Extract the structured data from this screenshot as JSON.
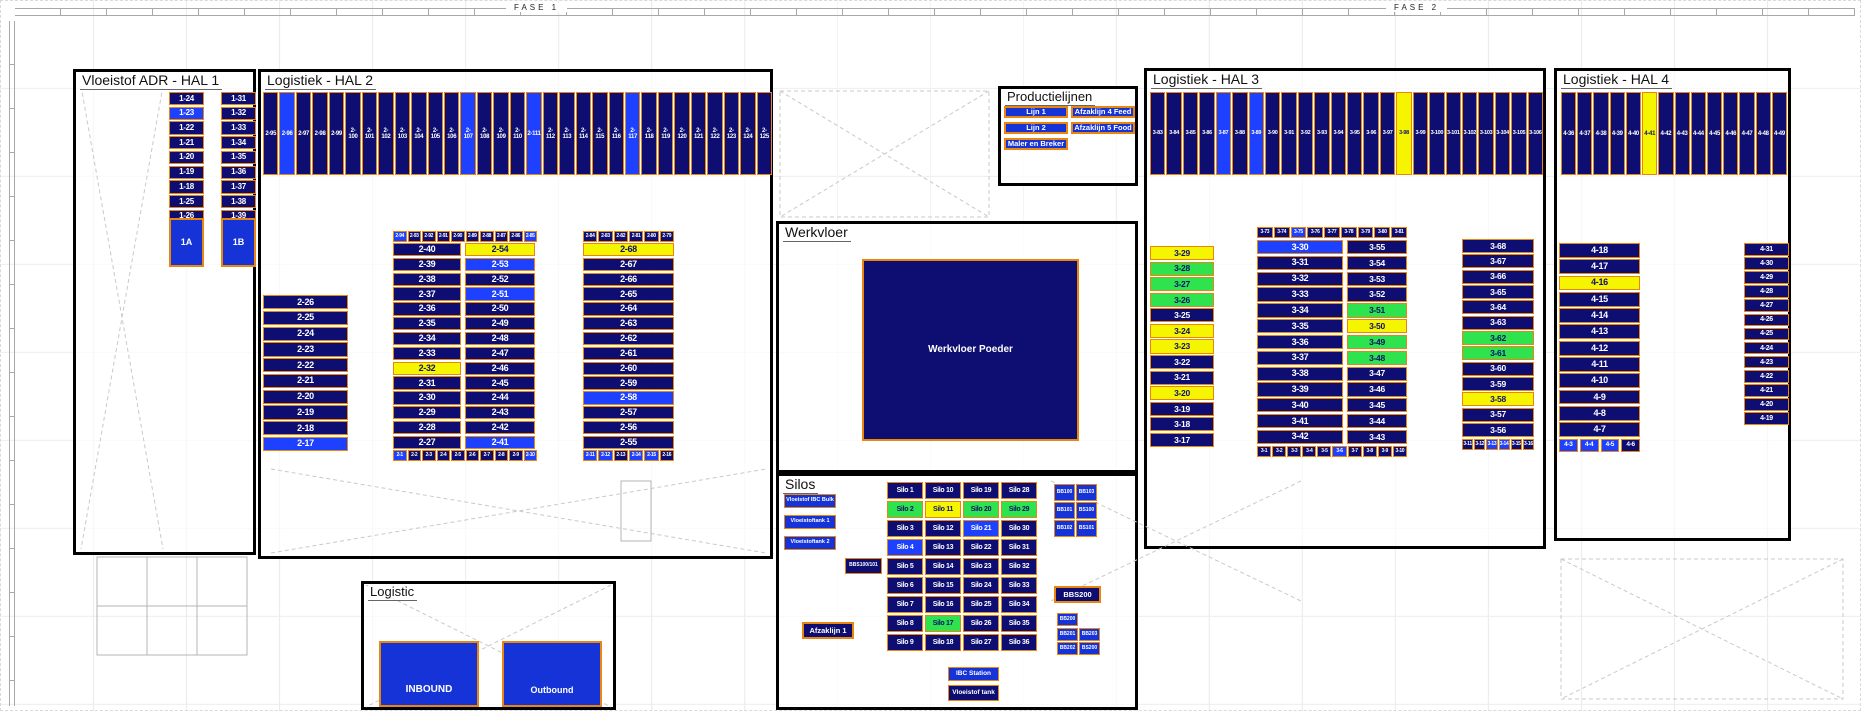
{
  "colors": {
    "navy": "#0e0e72",
    "hblue": "#1e40ff",
    "bblue": "#1533d6",
    "yellow": "#f5f500",
    "green": "#2fe34f",
    "orange": "#e8860d"
  },
  "ruler": {
    "fase1": "FASE 1",
    "fase2": "FASE 2"
  },
  "zones": {
    "hal1": {
      "title": "Vloeistof ADR - HAL 1",
      "col1": [
        "1-24",
        {
          "t": "1-23",
          "s": "b"
        },
        "1-22",
        "1-21",
        "1-20",
        "1-19",
        "1-18",
        "1-25",
        "1-26"
      ],
      "col2": [
        "1-31",
        "1-32",
        "1-33",
        "1-34",
        "1-35",
        "1-36",
        "1-37",
        "1-38",
        "1-39"
      ],
      "big1": "1A",
      "big2": "1B"
    },
    "hal2": {
      "title": "Logistiek - HAL 2",
      "top_row": [
        "2-95",
        {
          "t": "2-96",
          "s": "b"
        },
        "2-97",
        "2-98",
        "2-99",
        "2-100",
        "2-101",
        "2-102",
        "2-103",
        "2-104",
        "2-105",
        "2-106",
        {
          "t": "2-107",
          "s": "b"
        },
        "2-108",
        "2-109",
        "2-110",
        {
          "t": "2-111",
          "s": "b"
        },
        "2-112",
        "2-113",
        "2-114",
        "2-115",
        "2-116",
        {
          "t": "2-117",
          "s": "b"
        },
        "2-118",
        "2-119",
        "2-120",
        "2-121",
        "2-122",
        "2-123",
        "2-124",
        "2-125"
      ],
      "left_col": [
        "2-26",
        "2-25",
        "2-24",
        "2-23",
        "2-22",
        "2-21",
        "2-20",
        "2-19",
        "2-18",
        {
          "t": "2-17",
          "s": "b"
        }
      ],
      "g1_top": [
        {
          "t": "2-94",
          "s": "b"
        },
        "2-93",
        "2-92",
        "2-91",
        "2-90",
        "2-89",
        "2-88",
        "2-87",
        "2-86",
        {
          "t": "2-85",
          "s": "b"
        }
      ],
      "g1_colA": [
        "2-40",
        "2-39",
        "2-38",
        "2-37",
        "2-36",
        "2-35",
        "2-34",
        "2-33",
        {
          "t": "2-32",
          "s": "y"
        },
        "2-31",
        "2-30",
        "2-29",
        "2-28",
        "2-27"
      ],
      "g1_colB": [
        {
          "t": "2-54",
          "s": "y"
        },
        {
          "t": "2-53",
          "s": "b"
        },
        "2-52",
        {
          "t": "2-51",
          "s": "b"
        },
        "2-50",
        "2-49",
        "2-48",
        "2-47",
        "2-46",
        "2-45",
        "2-44",
        "2-43",
        "2-42",
        {
          "t": "2-41",
          "s": "b"
        }
      ],
      "g1_bottom": [
        {
          "t": "2-1",
          "s": "b"
        },
        "2-2",
        "2-3",
        "2-4",
        "2-5",
        "2-6",
        "2-7",
        "2-8",
        "2-9",
        {
          "t": "2-10",
          "s": "b"
        }
      ],
      "g2_top": [
        "2-84",
        "2-83",
        "2-82",
        "2-81",
        "2-80",
        "2-79"
      ],
      "g2_col": [
        {
          "t": "2-68",
          "s": "y"
        },
        "2-67",
        "2-66",
        "2-65",
        "2-64",
        "2-63",
        "2-62",
        "2-61",
        "2-60",
        "2-59",
        {
          "t": "2-58",
          "s": "b"
        },
        "2-57",
        "2-56",
        "2-55"
      ],
      "g2_bottom": [
        {
          "t": "2-11",
          "s": "b"
        },
        {
          "t": "2-12",
          "s": "b"
        },
        "2-13",
        {
          "t": "2-14",
          "s": "b"
        },
        {
          "t": "2-15",
          "s": "b"
        },
        "2-16"
      ]
    },
    "productielijnen": {
      "title": "Productielijnen",
      "left_buttons": [
        "Lijn 1",
        "Lijn 2",
        "Maler en Breker"
      ],
      "right_buttons": [
        "Afzaklijn 4 Feed",
        "Afzaklijn 5 Food"
      ]
    },
    "werkvloer": {
      "title": "Werkvloer",
      "box_label": "Werkvloer Poeder"
    },
    "silos": {
      "title": "Silos",
      "left_tanks": [
        "Vloeistof IBC Bulk",
        "Vloeistoftank 1",
        "Vloeistoftank 2"
      ],
      "bbs100": "BBS100/101",
      "afzaklijn1": "Afzaklijn 1",
      "grid": [
        "Silo 1",
        "Silo 10",
        "Silo 19",
        "Silo 28",
        {
          "t": "Silo 2",
          "s": "g"
        },
        {
          "t": "Silo 11",
          "s": "y"
        },
        {
          "t": "Silo 20",
          "s": "g"
        },
        {
          "t": "Silo 29",
          "s": "g"
        },
        "Silo 3",
        "Silo 12",
        {
          "t": "Silo 21",
          "s": "b"
        },
        "Silo 30",
        {
          "t": "Silo 4",
          "s": "b"
        },
        "Silo 13",
        "Silo 22",
        "Silo 31",
        "Silo 5",
        "Silo 14",
        "Silo 23",
        "Silo 32",
        "Silo 6",
        "Silo 15",
        "Silo 24",
        "Silo 33",
        "Silo 7",
        "Silo 16",
        "Silo 25",
        "Silo 34",
        "Silo 8",
        {
          "t": "Silo 17",
          "s": "g"
        },
        "Silo 26",
        "Silo 35",
        "Silo 9",
        "Silo 18",
        "Silo 27",
        "Silo 36"
      ],
      "right_top": [
        "BB100",
        "BB103",
        "BB101",
        "BS100",
        "BB102",
        "BS101"
      ],
      "bbs200": "BBS200",
      "bb200": "BB200",
      "right_bottom": [
        "BB201",
        "BB203",
        "BB202",
        "BS200"
      ],
      "ibc_station": "IBC Station",
      "vloeistof_tank": "Vloeistof tank"
    },
    "hal3": {
      "title": "Logistiek - HAL 3",
      "top_row": [
        "3-83",
        "3-84",
        "3-85",
        "3-86",
        {
          "t": "3-87",
          "s": "b"
        },
        "3-88",
        {
          "t": "3-89",
          "s": "b"
        },
        "3-90",
        "3-91",
        "3-92",
        "3-93",
        "3-94",
        "3-95",
        "3-96",
        "3-97",
        {
          "t": "3-98",
          "s": "y"
        },
        "3-99",
        "3-100",
        "3-101",
        "3-102",
        "3-103",
        "3-104",
        "3-105",
        "3-106"
      ],
      "colA": [
        {
          "t": "3-29",
          "s": "y"
        },
        {
          "t": "3-28",
          "s": "g"
        },
        {
          "t": "3-27",
          "s": "g"
        },
        {
          "t": "3-26",
          "s": "g"
        },
        "3-25",
        {
          "t": "3-24",
          "s": "y"
        },
        {
          "t": "3-23",
          "s": "y"
        },
        "3-22",
        "3-21",
        {
          "t": "3-20",
          "s": "y"
        },
        "3-19",
        "3-18",
        "3-17"
      ],
      "bc_top": [
        "3-73",
        "3-74",
        {
          "t": "3-75",
          "s": "b"
        },
        "3-76",
        "3-77",
        "3-78",
        "3-79",
        "3-80",
        "3-81"
      ],
      "colB": [
        {
          "t": "3-30",
          "s": "b"
        },
        "3-31",
        "3-32",
        "3-33",
        "3-34",
        "3-35",
        "3-36",
        "3-37",
        "3-38",
        "3-39",
        "3-40",
        "3-41",
        "3-42"
      ],
      "colC": [
        "3-55",
        "3-54",
        "3-53",
        "3-52",
        {
          "t": "3-51",
          "s": "g"
        },
        {
          "t": "3-50",
          "s": "y"
        },
        {
          "t": "3-49",
          "s": "g"
        },
        {
          "t": "3-48",
          "s": "g"
        },
        "3-47",
        "3-46",
        "3-45",
        "3-44",
        "3-43"
      ],
      "bc_bottom": [
        "3-1",
        "3-2",
        "3-3",
        "3-4",
        "3-5",
        {
          "t": "3-6",
          "s": "b"
        },
        "3-7",
        "3-8",
        "3-9",
        "3-10"
      ],
      "colD": [
        "3-68",
        "3-67",
        "3-66",
        "3-65",
        "3-64",
        "3-63",
        {
          "t": "3-62",
          "s": "g"
        },
        {
          "t": "3-61",
          "s": "g"
        },
        "3-60",
        "3-59",
        {
          "t": "3-58",
          "s": "y"
        },
        "3-57",
        "3-56"
      ],
      "d_bottom": [
        "3-11",
        "3-12",
        {
          "t": "3-13",
          "s": "b"
        },
        {
          "t": "3-14",
          "s": "b"
        },
        "3-15",
        "3-16"
      ]
    },
    "hal4": {
      "title": "Logistiek - HAL 4",
      "top_row": [
        "4-36",
        "4-37",
        "4-38",
        "4-39",
        "4-40",
        {
          "t": "4-41",
          "s": "y"
        },
        "4-42",
        "4-43",
        "4-44",
        "4-45",
        "4-46",
        "4-47",
        "4-48",
        "4-49"
      ],
      "colE": [
        "4-18",
        "4-17",
        {
          "t": "4-16",
          "s": "y"
        },
        "4-15",
        "4-14",
        "4-13",
        "4-12",
        "4-11",
        "4-10",
        "4-9",
        "4-8",
        "4-7"
      ],
      "e_bottom": [
        {
          "t": "4-3",
          "s": "b"
        },
        {
          "t": "4-4",
          "s": "b"
        },
        {
          "t": "4-5",
          "s": "b"
        },
        "4-6"
      ],
      "colF": [
        "4-31",
        "4-30",
        "4-29",
        "4-28",
        "4-27",
        "4-26",
        "4-25",
        "4-24",
        "4-23",
        "4-22",
        "4-21",
        "4-20",
        "4-19"
      ]
    },
    "logistic": {
      "title": "Logistic",
      "inbound": "INBOUND",
      "outbound": "Outbound"
    }
  }
}
